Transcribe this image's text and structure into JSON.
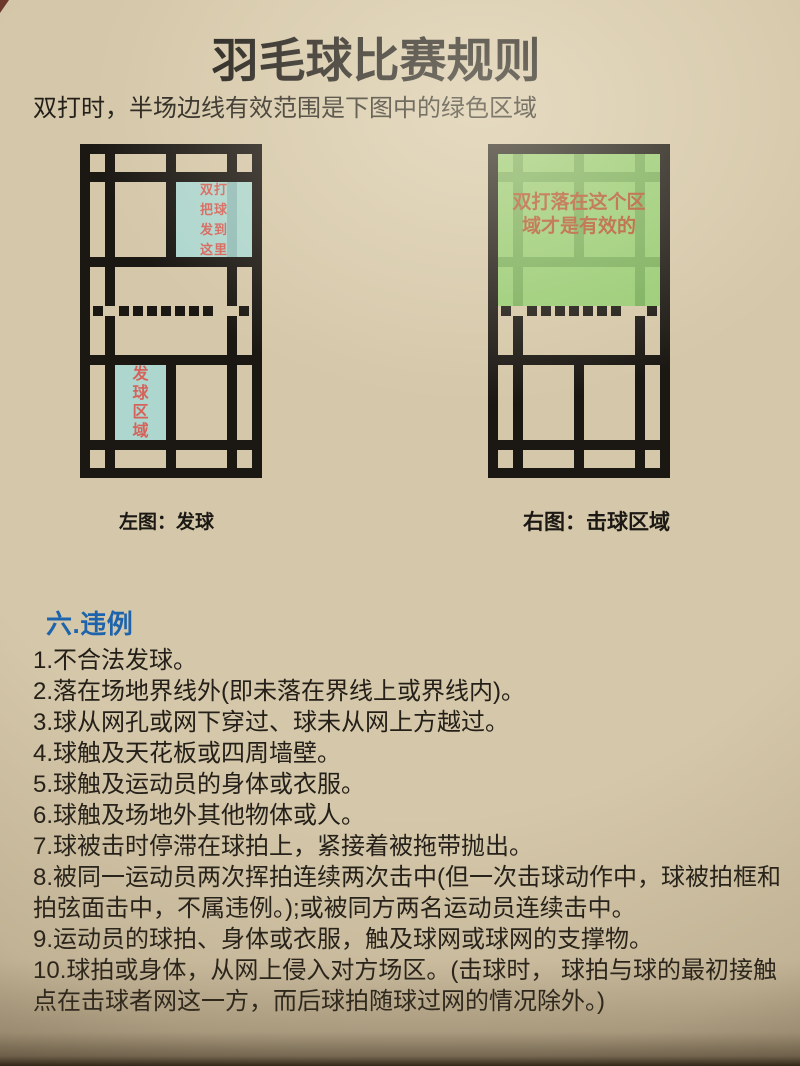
{
  "page": {
    "title": "羽毛球比赛规则",
    "subtitle": "双打时，半场边线有效范围是下图中的绿色区域"
  },
  "left_court": {
    "caption": "左图：发球",
    "serve_target_lines": [
      "双打",
      "把球",
      "发到",
      "这里"
    ],
    "service_area_chars": [
      "发",
      "球",
      "区",
      "域"
    ]
  },
  "right_court": {
    "caption": "右图：击球区域",
    "valid_zone_lines": [
      "双打落在这个区",
      "域才是有效的"
    ]
  },
  "rules_section": {
    "heading": "六.违例",
    "items": [
      "1.不合法发球。",
      "2.落在场地界线外(即未落在界线上或界线内)。",
      "3.球从网孔或网下穿过、球未从网上方越过。",
      "4.球触及天花板或四周墙壁。",
      "5.球触及运动员的身体或衣服。",
      "6.球触及场地外其他物体或人。",
      "7.球被击时停滞在球拍上，紧接着被拖带抛出。",
      "8.被同一运动员两次挥拍连续两次击中(但一次击球动作中，球被拍框和拍弦面击中，不属违例。);或被同方两名运动员连续击中。",
      "9.运动员的球拍、身体或衣服，触及球网或球网的支撑物。",
      "10.球拍或身体，从网上侵入对方场区。(击球时， 球拍与球的最初接触点在击球者网这一方，而后球拍随球过网的情况除外。)"
    ]
  },
  "colors": {
    "paper": "#d5c7a9",
    "court_line": "#1b1713",
    "serve_zone_blue": "#a7d8d4",
    "zone_label_red": "#d5635a",
    "valid_zone_green": "#8ccd69",
    "valid_zone_label_orange": "#b2552f",
    "heading_blue": "#1d64ad",
    "body_text": "#242019"
  }
}
